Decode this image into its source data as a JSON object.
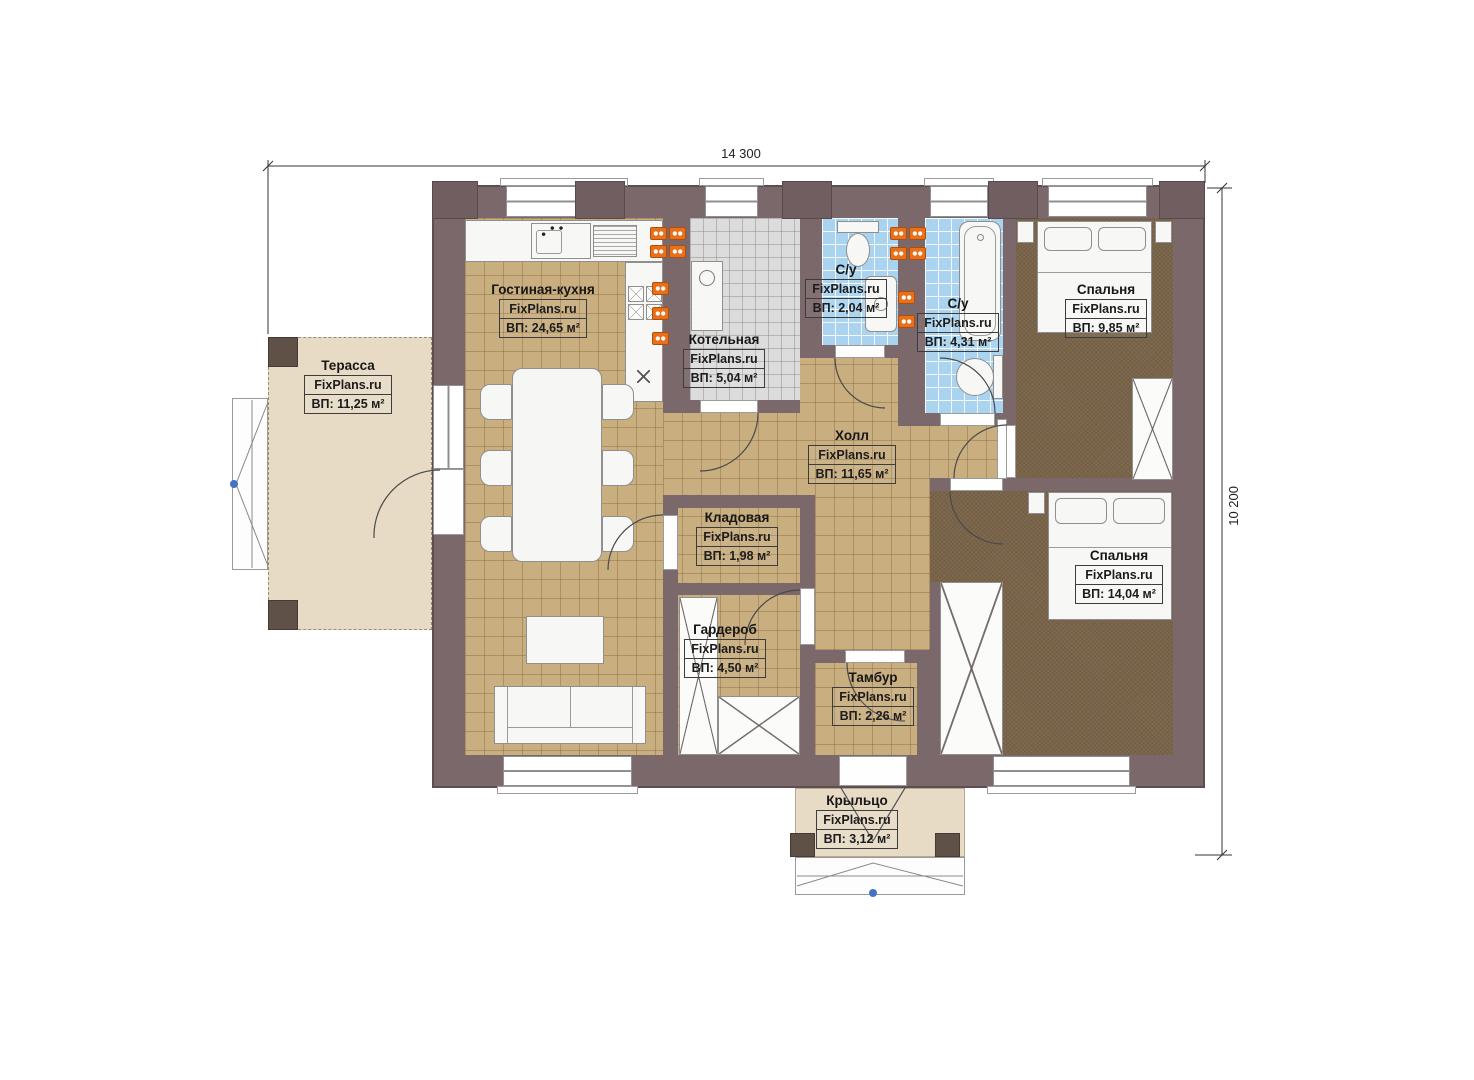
{
  "watermark": "FixPlans.ru",
  "dimensions": {
    "width": "14 300",
    "height": "10 200"
  },
  "rooms": {
    "living_kitchen": {
      "name": "Гостиная-кухня",
      "area": "ВП: 24,65 м²"
    },
    "boiler": {
      "name": "Котельная",
      "area": "ВП: 5,04 м²"
    },
    "bathroom_small": {
      "name": "С/у",
      "area": "ВП: 2,04 м²"
    },
    "bathroom_large": {
      "name": "С/у",
      "area": "ВП: 4,31 м²"
    },
    "bedroom_1": {
      "name": "Спальня",
      "area": "ВП: 9,85 м²"
    },
    "bedroom_2": {
      "name": "Спальня",
      "area": "ВП: 14,04 м²"
    },
    "hall": {
      "name": "Холл",
      "area": "ВП: 11,65 м²"
    },
    "storage": {
      "name": "Кладовая",
      "area": "ВП: 1,98 м²"
    },
    "wardrobe": {
      "name": "Гардероб",
      "area": "ВП: 4,50 м²"
    },
    "vestibule": {
      "name": "Тамбур",
      "area": "ВП: 2,26 м²"
    },
    "terrace": {
      "name": "Терасса",
      "area": "ВП: 11,25 м²"
    },
    "porch": {
      "name": "Крыльцо",
      "area": "ВП: 3,12 м²"
    }
  },
  "colors": {
    "wall": "#7b686a",
    "tile_floor": "#c9ae80",
    "bathroom_floor": "#a9d3ee",
    "boiler_floor": "#dcdcdc",
    "carpet": "#796449",
    "terrace_floor": "#e7dbc6",
    "radiator": "#e8701a",
    "marker_blue": "#4472c4"
  }
}
